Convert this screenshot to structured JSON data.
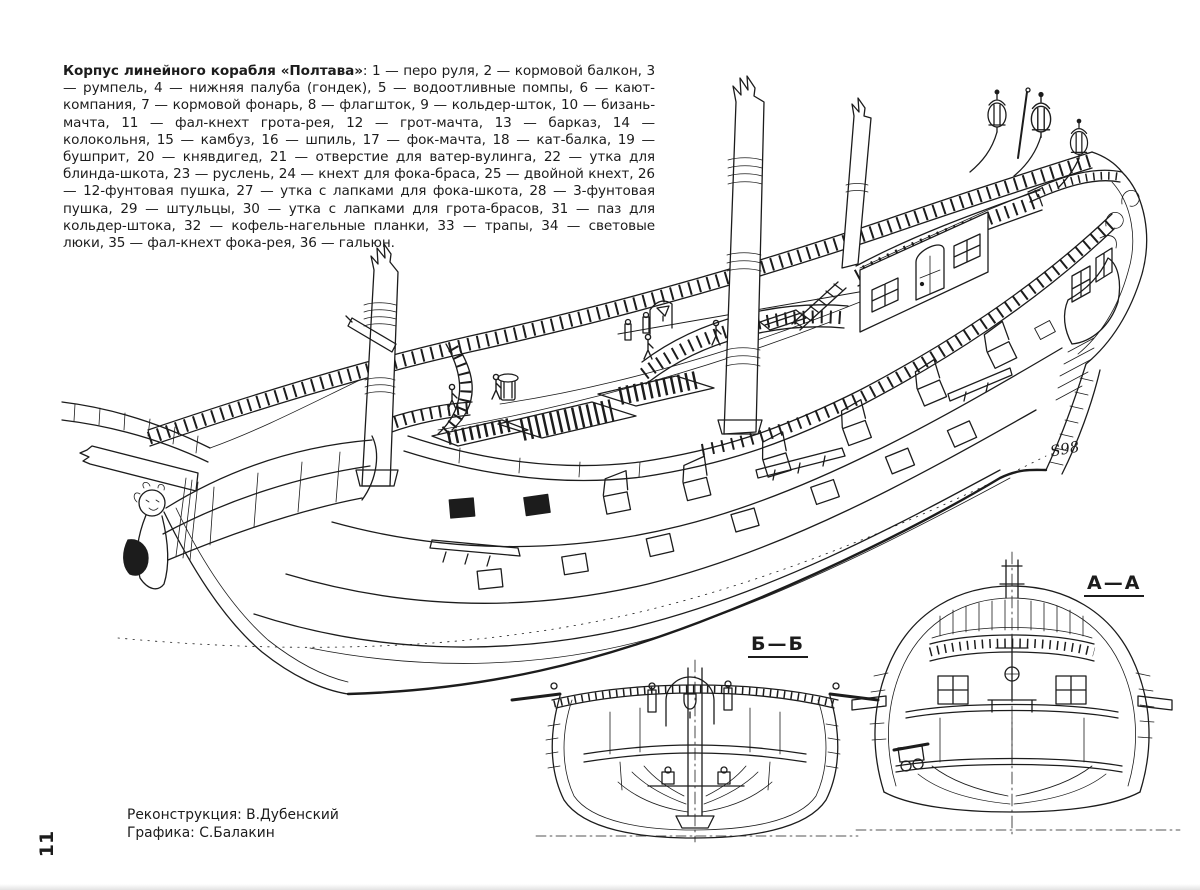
{
  "caption": {
    "title_bold": "Корпус линейного корабля «Полтава»",
    "body": ": 1 — перо руля, 2 — кормовой балкон, 3 — румпель, 4 — нижняя палуба (гондек), 5 — водоотливные помпы, 6 — кают-компания, 7 — кормовой фонарь, 8 — флагшток, 9 — кольдер-шток, 10 — бизань-мачта, 11 — фал-кнехт грота-рея, 12 — грот-мачта, 13 — барказ, 14 — колокольня, 15 — камбуз, 16 — шпиль, 17 — фок-мачта, 18 — кат-балка, 19 — бушприт, 20 — княвдигед, 21 — отверстие для ватер-вулинга, 22 — утка для блинда-шкота, 23 — руслень, 24 — кнехт для фока-браса, 25 — двойной кнехт, 26 — 12-фунтовая пушка, 27 — утка с лапками для фока-шкота, 28 — 3-фунтовая пушка, 29 — штульцы, 30 — утка с лапками для грота-брасов, 31 — паз для кольдер-штока, 32 — кофель-нагельные планки, 33 — трапы, 34 — световые люки, 35 — фал-кнехт фока-рея, 36 — гальюн."
  },
  "sections": {
    "b": "Б—Б",
    "a": "А—А"
  },
  "signature": "S98",
  "credits": {
    "reconstruction": "Реконструкция: В.Дубенский",
    "graphics": "Графика: С.Балакин"
  },
  "page_number": "11",
  "colors": {
    "ink": "#1c1c1c",
    "paper": "#ffffff"
  }
}
